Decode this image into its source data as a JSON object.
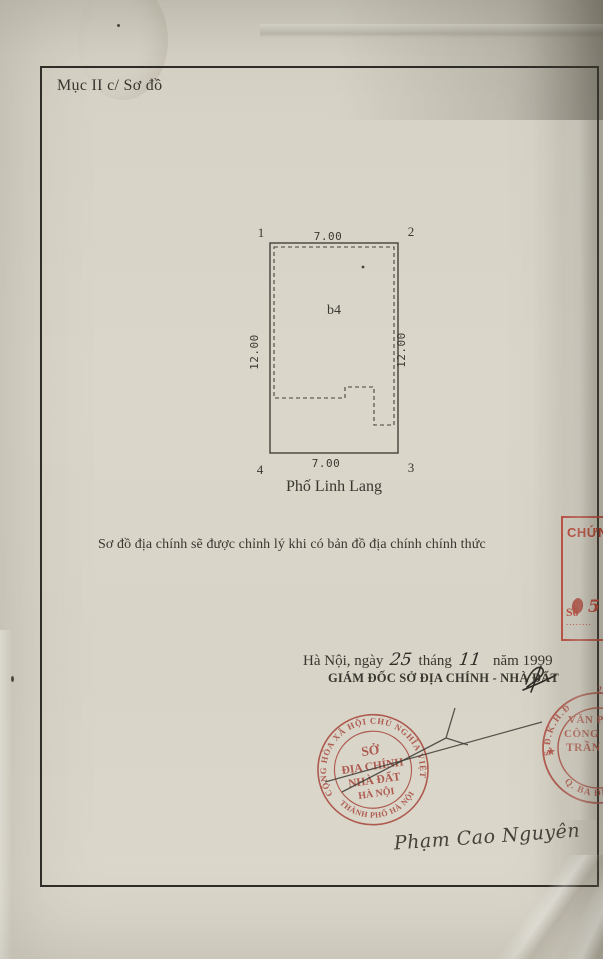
{
  "header": {
    "section_label": "Mục II c/ Sơ đồ"
  },
  "diagram": {
    "corners": [
      "1",
      "2",
      "3",
      "4"
    ],
    "top_dim": "7.00",
    "bottom_dim": "7.00",
    "left_dim": "12.00",
    "right_dim": "12.00",
    "plot_label": "b4",
    "street": "Phố Linh Lang"
  },
  "note": {
    "text": "Sơ đồ địa chính sẽ được chỉnh lý khi có bản đồ địa chính chính thức"
  },
  "signoff": {
    "place_prefix": "Hà Nội, ngày",
    "day": "25",
    "month_label": "tháng",
    "month": "11",
    "year_label": "năm",
    "year": "1999",
    "title": "GIÁM ĐỐC SỞ ĐỊA CHÍNH - NHÀ ĐẤT",
    "signatory": "Phạm Cao Nguyên"
  },
  "stamps": {
    "main": {
      "color": "#a84a3f",
      "ring_top": "CỘNG HÒA XÃ HỘI CHỦ NGHĨA VIỆT NAM",
      "ring_bottom": "★ THÀNH PHỐ HÀ NỘI ★",
      "line1": "SỞ",
      "line2": "ĐỊA CHÍNH",
      "line3": "NHÀ ĐẤT",
      "line4": "HÀ NỘI"
    },
    "cert_box": {
      "color": "#c03a2b",
      "title": "CHỨNG",
      "so_label": "Số",
      "dots": "........",
      "number": "5"
    },
    "notary": {
      "color": "#b04a3f",
      "arc_top": "S.Đ.K.H.Đ",
      "arc_bottom": "Q. BA ĐÌNH",
      "star": "★",
      "line1": "VĂN P",
      "line2": "CÔNG",
      "line3": "TRẦN",
      "corner_digit": "2"
    }
  },
  "colors": {
    "ink": "#38362f",
    "paper": "#d8d4c8"
  }
}
